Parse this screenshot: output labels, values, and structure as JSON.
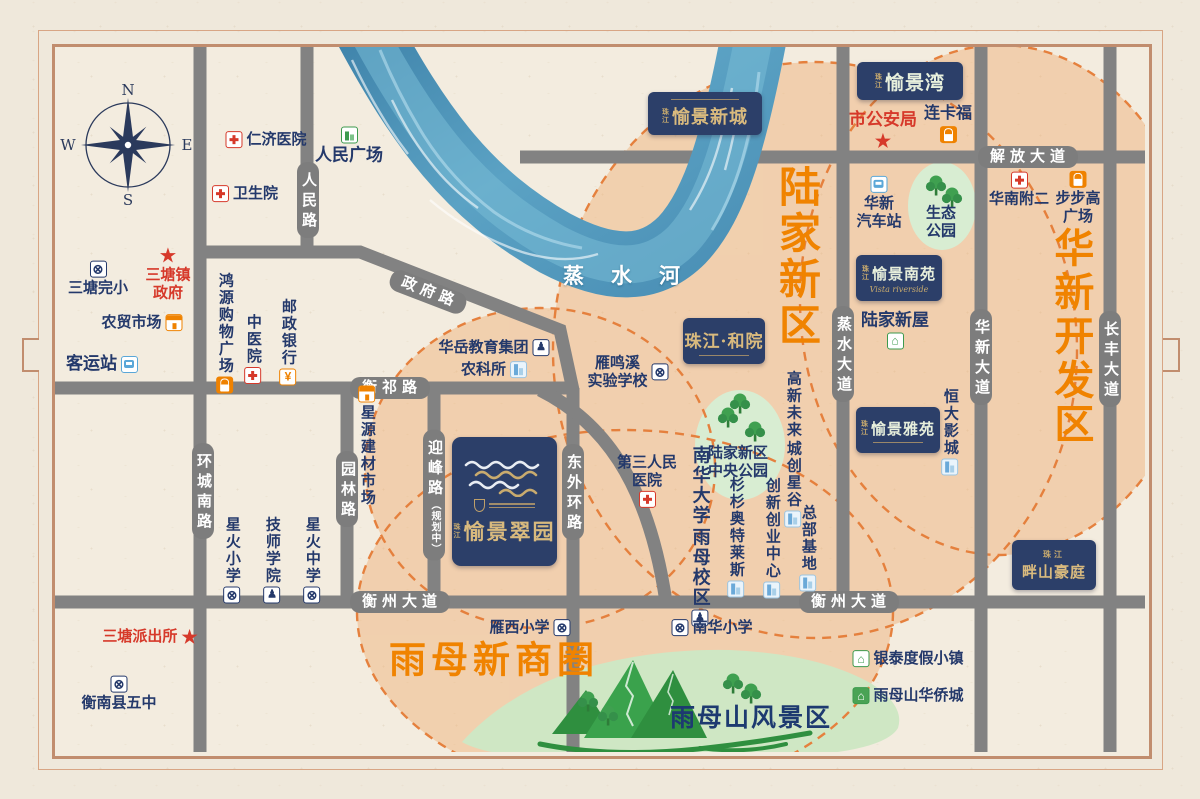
{
  "colors": {
    "accent_orange": "#f08300",
    "navy": "#24396b",
    "red": "#d6392a",
    "badge_navy": "#2c3f69",
    "gold": "#d9ba7e",
    "road_gray": "#828282",
    "river_blue": "#4a8fb5",
    "peach": "#f2b37e",
    "park_green": "#d5ebcb",
    "tree_green": "#35904a"
  },
  "glyphs": {
    "school": "⊗",
    "edu": "♟",
    "bank": "¥",
    "pavilion": "⌂",
    "pavilion-filled": "⌂",
    "star": "★"
  },
  "map": {
    "compass": {
      "n": "N",
      "e": "E",
      "s": "S",
      "w": "W"
    },
    "river": {
      "name": "蒸水河"
    },
    "scenic": {
      "label": "雨母山风景区"
    },
    "zones": [
      {
        "name": "lujia-new-district",
        "text": "陆家新区",
        "x": 797,
        "y": 257,
        "vertical": true,
        "size": 42,
        "color": "#f08300",
        "ls": 4
      },
      {
        "name": "huaxin-development-zone",
        "text": "华新开发区",
        "x": 1070,
        "y": 337,
        "vertical": true,
        "size": 40,
        "color": "#f08300",
        "ls": 4
      },
      {
        "name": "yumu-new-business-circle",
        "text": "雨母新商圈",
        "x": 494,
        "y": 660,
        "vertical": false,
        "size": 37,
        "color": "#f08300",
        "ls": 5
      }
    ],
    "road_labels": [
      {
        "name": "renmin-lu",
        "text": "人民路",
        "x": 308,
        "y": 200,
        "vertical": true
      },
      {
        "name": "zhengfu-lu",
        "text": "政府路",
        "x": 428,
        "y": 292,
        "rotate": 21
      },
      {
        "name": "hengqi-lu",
        "text": "衡祁路",
        "x": 390,
        "y": 388
      },
      {
        "name": "huancheng-nan-lu",
        "text": "环城南路",
        "x": 203,
        "y": 491,
        "vertical": true
      },
      {
        "name": "yuanlin-lu",
        "text": "园林路",
        "x": 347,
        "y": 489,
        "vertical": true
      },
      {
        "name": "yingfeng-lu",
        "text": "迎峰路",
        "sub": "（规划中）",
        "x": 434,
        "y": 495,
        "vertical": true
      },
      {
        "name": "dongwai-huan-lu",
        "text": "东外环路",
        "x": 573,
        "y": 492,
        "vertical": true
      },
      {
        "name": "hengzhou-dadao-west",
        "text": "衡州大道",
        "x": 400,
        "y": 602
      },
      {
        "name": "hengzhou-dadao-east",
        "text": "衡州大道",
        "x": 849,
        "y": 602
      },
      {
        "name": "jiefang-dadao",
        "text": "解放大道",
        "x": 1028,
        "y": 157
      },
      {
        "name": "zhengshui-dadao",
        "text": "蒸水大道",
        "x": 843,
        "y": 354,
        "vertical": true
      },
      {
        "name": "huaxin-dadao",
        "text": "华新大道",
        "x": 981,
        "y": 357,
        "vertical": true
      },
      {
        "name": "changfeng-dadao",
        "text": "长丰大道",
        "x": 1110,
        "y": 359,
        "vertical": true
      }
    ],
    "badges": [
      {
        "name": "vista-new-city-badge",
        "prefix": "珠江",
        "title": "愉景新城",
        "x": 648,
        "y": 92,
        "w": 114,
        "h": 43,
        "titleClass": "gold",
        "titleSize": 18,
        "line": true,
        "lineTop": true
      },
      {
        "name": "vista-bay-badge",
        "prefix": "珠江",
        "title": "愉景湾",
        "x": 857,
        "y": 62,
        "w": 106,
        "h": 38,
        "titleClass": "mint",
        "titleSize": 19
      },
      {
        "name": "vista-south-court-badge",
        "prefix": "珠江",
        "title": "愉景南苑",
        "subtitle": "Vista riverside",
        "x": 856,
        "y": 255,
        "w": 86,
        "h": 46,
        "titleClass": "mint",
        "titleSize": 15
      },
      {
        "name": "zhujiang-heyuan-badge",
        "title": "珠江·和院",
        "x": 683,
        "y": 318,
        "w": 82,
        "h": 46,
        "titleClass": "gold",
        "titleSize": 17,
        "line": true
      },
      {
        "name": "vista-elegant-court-badge",
        "prefix": "珠江",
        "title": "愉景雅苑",
        "x": 856,
        "y": 407,
        "w": 84,
        "h": 46,
        "titleClass": "mint",
        "titleSize": 15,
        "line": true
      },
      {
        "name": "banshan-haoting-badge",
        "prefixTop": "珠江",
        "title": "畔山豪庭",
        "x": 1012,
        "y": 540,
        "w": 84,
        "h": 50,
        "titleClass": "gold",
        "titleSize": 15
      }
    ],
    "main_badge": {
      "name": "project-badge-vista-emerald-garden",
      "prefix": "珠江",
      "title": "愉景翠园",
      "x": 452,
      "y": 437,
      "w": 105,
      "h": 129,
      "titleSize": 21
    },
    "landmarks": [
      {
        "name": "renji-hospital",
        "text": "仁济医院",
        "icon": "hospital",
        "iconPos": "left",
        "x": 266,
        "y": 140
      },
      {
        "name": "renmin-square",
        "text": "人民广场",
        "icon": "building-green",
        "iconPos": "top",
        "x": 349,
        "y": 146,
        "size": 17
      },
      {
        "name": "weishengyuan-clinic",
        "text": "卫生院",
        "icon": "hospital",
        "iconPos": "left",
        "x": 245,
        "y": 194
      },
      {
        "name": "santang-primary-school",
        "text": "三塘完小",
        "icon": "school",
        "iconPos": "top",
        "x": 98,
        "y": 279
      },
      {
        "name": "santang-town-government",
        "lines": [
          "三塘镇",
          "政府"
        ],
        "icon": "star",
        "iconPos": "top",
        "x": 168,
        "y": 274,
        "color": "red"
      },
      {
        "name": "nongmao-market",
        "text": "农贸市场",
        "icon": "market",
        "iconPos": "right",
        "x": 142,
        "y": 323
      },
      {
        "name": "bus-terminal",
        "text": "客运站",
        "icon": "bus",
        "iconPos": "right",
        "x": 102,
        "y": 364,
        "size": 17
      },
      {
        "name": "hongyuan-shopping-plaza",
        "text": "鸿源购物广场",
        "vertical": true,
        "icon": "bag",
        "iconPos": "bottom",
        "x": 225,
        "y": 333
      },
      {
        "name": "tcm-hospital",
        "text": "中医院",
        "vertical": true,
        "icon": "hospital",
        "iconPos": "bottom",
        "x": 253,
        "y": 349
      },
      {
        "name": "postal-savings-bank",
        "text": "邮政银行",
        "vertical": true,
        "icon": "bank",
        "iconPos": "bottom",
        "x": 288,
        "y": 342
      },
      {
        "name": "santang-police-station",
        "text": "三塘派出所",
        "icon": "star",
        "iconPos": "right",
        "x": 150,
        "y": 637,
        "color": "red"
      },
      {
        "name": "hengnan-no5-school",
        "text": "衡南县五中",
        "icon": "school",
        "iconPos": "top",
        "x": 119,
        "y": 694
      },
      {
        "name": "xinghuo-primary-school",
        "text": "星火小学",
        "vertical": true,
        "icon": "school",
        "iconPos": "bottom",
        "x": 232,
        "y": 560
      },
      {
        "name": "technician-college",
        "text": "技师学院",
        "vertical": true,
        "icon": "edu",
        "iconPos": "bottom",
        "x": 272,
        "y": 560
      },
      {
        "name": "xinghuo-middle-school",
        "text": "星火中学",
        "vertical": true,
        "icon": "school",
        "iconPos": "bottom",
        "x": 312,
        "y": 560
      },
      {
        "name": "xingyuan-building-materials-market",
        "text": "星源建材市场",
        "vertical": true,
        "icon": "market",
        "iconPos": "top",
        "x": 367,
        "y": 446
      },
      {
        "name": "huayue-education-group",
        "text": "华岳教育集团",
        "icon": "edu",
        "iconPos": "right",
        "x": 494,
        "y": 348
      },
      {
        "name": "agri-science-institute",
        "text": "农科所",
        "icon": "building",
        "iconPos": "right",
        "x": 494,
        "y": 370
      },
      {
        "name": "yanmingxi-experimental-school",
        "lines": [
          "雁鸣溪",
          "实验学校"
        ],
        "icon": "school",
        "iconPos": "right",
        "x": 628,
        "y": 372
      },
      {
        "name": "third-peoples-hospital",
        "lines": [
          "第三人民",
          "医院"
        ],
        "icon": "hospital",
        "iconPos": "bottom",
        "x": 647,
        "y": 481
      },
      {
        "name": "usc-yumu-campus",
        "cols": [
          "南华大学",
          "雨母校区"
        ],
        "icon": "edu",
        "iconPos": "bottom",
        "x": 700,
        "y": 536,
        "size": 18
      },
      {
        "name": "shanshan-outlets",
        "text": "杉杉奥特莱斯",
        "vertical": true,
        "icon": "building",
        "iconPos": "bottom",
        "x": 736,
        "y": 537
      },
      {
        "name": "innovation-entrepreneurship-center",
        "text": "创新创业中心",
        "vertical": true,
        "icon": "building",
        "iconPos": "bottom",
        "x": 772,
        "y": 538
      },
      {
        "name": "headquarters-base",
        "text": "总部基地",
        "vertical": true,
        "icon": "building",
        "iconPos": "bottom",
        "x": 808,
        "y": 548
      },
      {
        "name": "gaoxin-future-city-star-valley",
        "cols": [
          "高新未来",
          "城创星谷"
        ],
        "icon": "building",
        "iconPos": "bottom",
        "x": 793,
        "y": 449
      },
      {
        "name": "lujia-central-park-label",
        "lines": [
          "陆家新区",
          "中央公园"
        ],
        "x": 738,
        "y": 462
      },
      {
        "name": "eco-park-label",
        "lines": [
          "生态",
          "公园"
        ],
        "x": 941,
        "y": 222
      },
      {
        "name": "huaxin-bus-station",
        "lines": [
          "华新",
          "汽车站"
        ],
        "icon": "bus",
        "iconPos": "top",
        "x": 879,
        "y": 203
      },
      {
        "name": "lujia-xinwu",
        "text": "陆家新屋",
        "icon": "pavilion",
        "iconPos": "bottom",
        "x": 895,
        "y": 330,
        "size": 17
      },
      {
        "name": "city-public-security-bureau",
        "text": "市公安局",
        "icon": "star",
        "iconPos": "bottom",
        "x": 883,
        "y": 130,
        "color": "red",
        "size": 17
      },
      {
        "name": "liankafu",
        "text": "连卡福",
        "icon": "bag",
        "iconPos": "bottom",
        "x": 948,
        "y": 124,
        "size": 16
      },
      {
        "name": "huanan-affiliated-no2-hospital",
        "text": "华南附二",
        "icon": "hospital",
        "iconPos": "top",
        "x": 1019,
        "y": 190
      },
      {
        "name": "bubugao-plaza",
        "lines": [
          "步步高",
          "广场"
        ],
        "icon": "bag",
        "iconPos": "top",
        "x": 1078,
        "y": 198
      },
      {
        "name": "hengda-cinema",
        "text": "恒大影城",
        "vertical": true,
        "icon": "building",
        "iconPos": "bottom",
        "x": 950,
        "y": 432
      },
      {
        "name": "yintai-resort-town",
        "text": "银泰度假小镇",
        "icon": "pavilion",
        "iconPos": "left",
        "x": 908,
        "y": 659
      },
      {
        "name": "yumushan-overseas-chinese-town",
        "text": "雨母山华侨城",
        "icon": "pavilion-filled",
        "iconPos": "left",
        "x": 908,
        "y": 696
      },
      {
        "name": "yanxi-primary-school",
        "text": "雁西小学",
        "icon": "school",
        "iconPos": "right",
        "x": 530,
        "y": 628
      },
      {
        "name": "nanhua-primary-school",
        "text": "南华小学",
        "icon": "school",
        "iconPos": "left",
        "x": 712,
        "y": 628
      }
    ]
  }
}
